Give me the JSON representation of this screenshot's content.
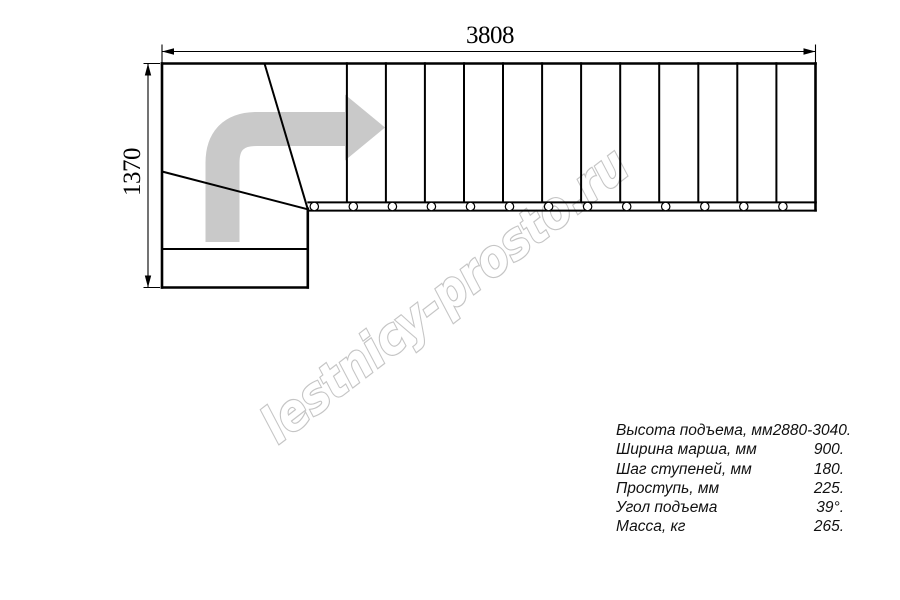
{
  "dimensions": {
    "top": {
      "value": "3808"
    },
    "left": {
      "value": "1370"
    }
  },
  "specs": {
    "rows": [
      {
        "label": "Высота подъема, мм",
        "value": "2880-3040."
      },
      {
        "label": "Ширина марша, мм",
        "value": "900."
      },
      {
        "label": "Шаг ступеней, мм",
        "value": "180."
      },
      {
        "label": "Проступь, мм",
        "value": "225."
      },
      {
        "label": "Угол подъема",
        "value": "39°."
      },
      {
        "label": "Масса, кг",
        "value": "265."
      }
    ]
  },
  "watermark": {
    "text": "lestnicy-prosto.ru",
    "color": "#c5c5c5"
  },
  "drawing": {
    "description": "Plan view of L-shaped staircase with winder turn, travel direction arrow pointing right",
    "line_color": "#000000",
    "arrow_color": "#c9c9c9",
    "straight_step_count": 13,
    "tread_xs": [
      346.9,
      385.9,
      424.9,
      464.0,
      503.0,
      542.1,
      581.1,
      620.2,
      659.2,
      698.3,
      737.3,
      776.4
    ],
    "bolt_xs": [
      314.3,
      353.3,
      392.4,
      431.4,
      470.5,
      509.5,
      548.6,
      587.6,
      626.7,
      665.7,
      704.8,
      743.8,
      782.9
    ]
  }
}
